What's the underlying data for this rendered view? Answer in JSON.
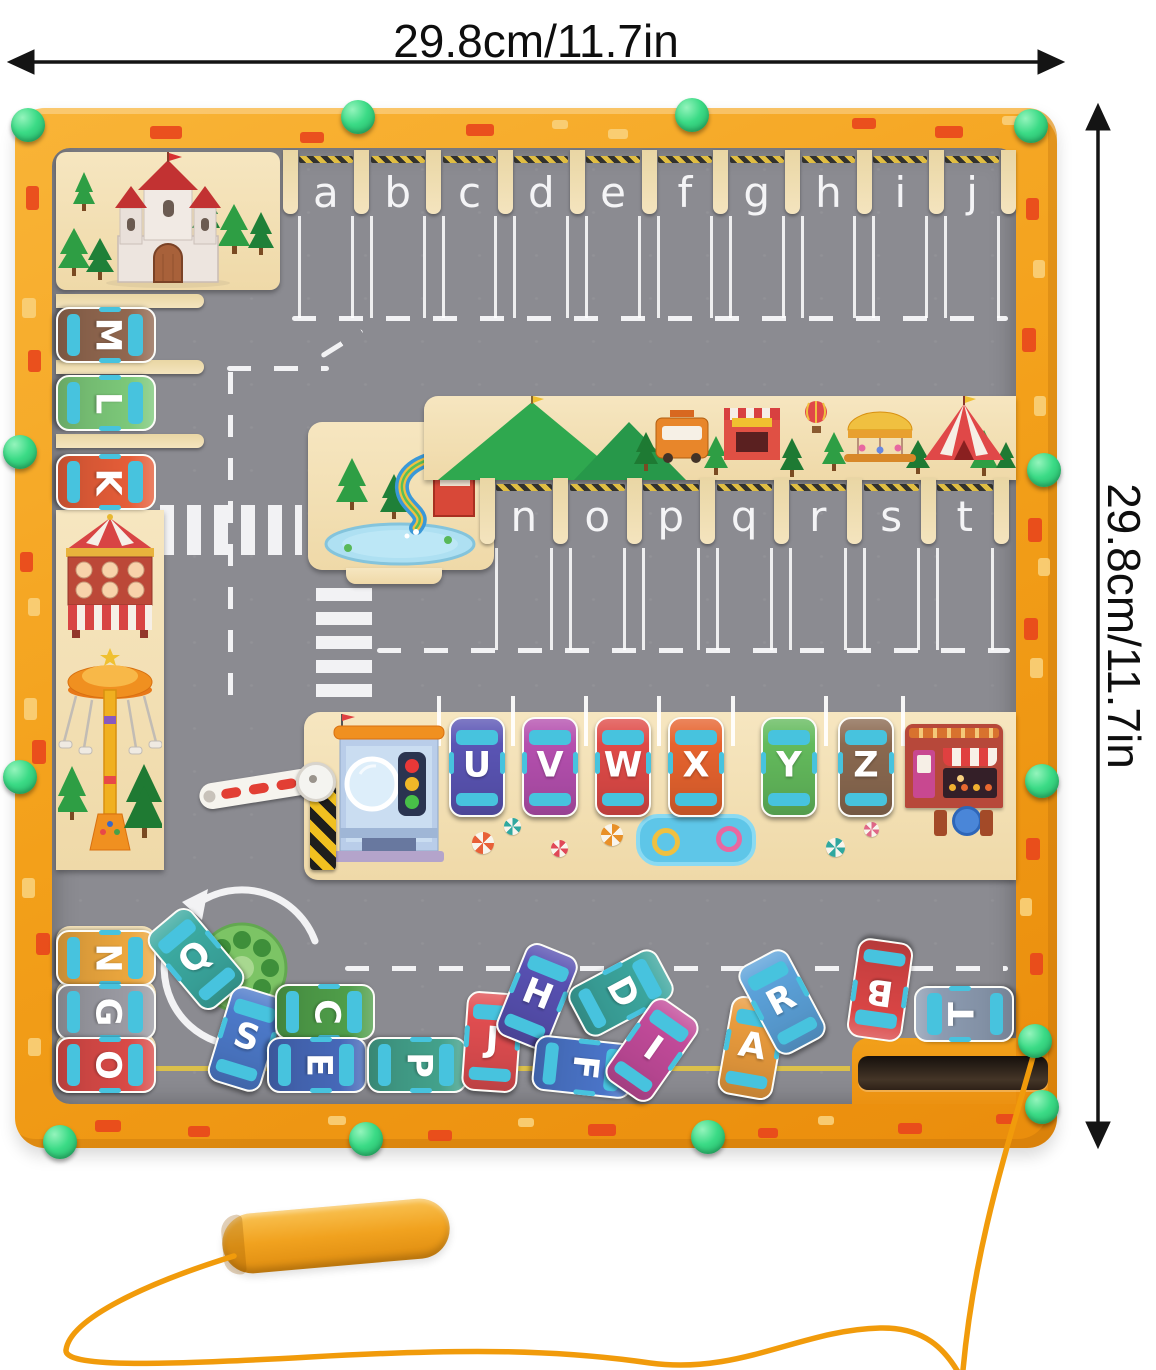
{
  "dimensions": {
    "top_label": "29.8cm/11.7in",
    "right_label": "29.8cm/11.7in"
  },
  "palette": {
    "frame": "#F3A01A",
    "road": "#8B8B91",
    "wood": "#F2DFB6",
    "knob": "#3BDB86",
    "marking": "#F2F2F4",
    "string": "#F19B0B",
    "hazard_yellow": "#E8C23C",
    "brick_red": "#E8481C"
  },
  "board": {
    "top_slot_letters": [
      "a",
      "b",
      "c",
      "d",
      "e",
      "f",
      "g",
      "h",
      "i",
      "j"
    ],
    "mid_slot_letters": [
      "n",
      "o",
      "p",
      "q",
      "r",
      "s",
      "t"
    ],
    "left_parked_cars": [
      {
        "letter": "M",
        "color": "#91674F"
      },
      {
        "letter": "L",
        "color": "#7CC879"
      },
      {
        "letter": "K",
        "color": "#E55D38"
      }
    ],
    "station_parked_cars": [
      {
        "letter": "U",
        "color": "#5A54B4"
      },
      {
        "letter": "V",
        "color": "#B44FAE"
      },
      {
        "letter": "W",
        "color": "#DF4A47"
      },
      {
        "letter": "X",
        "color": "#E6632E"
      },
      {
        "letter": "Y",
        "color": "#63BA5C"
      },
      {
        "letter": "Z",
        "color": "#8A6950"
      }
    ],
    "scattered_cars": [
      {
        "letter": "N",
        "color": "#ECA73E",
        "cx": 104,
        "cy": 956,
        "rot": 90
      },
      {
        "letter": "G",
        "color": "#9B9BA3",
        "cx": 104,
        "cy": 1010,
        "rot": 90
      },
      {
        "letter": "O",
        "color": "#D94A47",
        "cx": 104,
        "cy": 1063,
        "rot": 90
      },
      {
        "letter": "Q",
        "color": "#3BA9A0",
        "cx": 194,
        "cy": 957,
        "rot": -40
      },
      {
        "letter": "S",
        "color": "#4C79C9",
        "cx": 244,
        "cy": 1037,
        "rot": 17
      },
      {
        "letter": "C",
        "color": "#4F9E49",
        "cx": 323,
        "cy": 1010,
        "rot": 90
      },
      {
        "letter": "E",
        "color": "#4668B8",
        "cx": 315,
        "cy": 1063,
        "rot": 90
      },
      {
        "letter": "P",
        "color": "#43A18B",
        "cx": 415,
        "cy": 1063,
        "rot": 90
      },
      {
        "letter": "J",
        "color": "#E04D50",
        "cx": 490,
        "cy": 1040,
        "rot": 4
      },
      {
        "letter": "H",
        "color": "#5750B1",
        "cx": 535,
        "cy": 994,
        "rot": 22
      },
      {
        "letter": "D",
        "color": "#3BA59D",
        "cx": 619,
        "cy": 991,
        "rot": 62
      },
      {
        "letter": "F",
        "color": "#4A74C8",
        "cx": 581,
        "cy": 1065,
        "rot": 96
      },
      {
        "letter": "I",
        "color": "#C14A99",
        "cx": 650,
        "cy": 1048,
        "rot": 35
      },
      {
        "letter": "A",
        "color": "#E99B3D",
        "cx": 750,
        "cy": 1046,
        "rot": 10
      },
      {
        "letter": "R",
        "color": "#5BA1D9",
        "cx": 780,
        "cy": 1000,
        "rot": -28
      },
      {
        "letter": "B",
        "color": "#D94545",
        "cx": 878,
        "cy": 988,
        "rot": 188
      },
      {
        "letter": "T",
        "color": "#8C9BB1",
        "cx": 962,
        "cy": 1012,
        "rot": -90
      }
    ],
    "knobs": [
      [
        28,
        125
      ],
      [
        358,
        117
      ],
      [
        692,
        115
      ],
      [
        1031,
        126
      ],
      [
        20,
        452
      ],
      [
        20,
        777
      ],
      [
        1044,
        470
      ],
      [
        1042,
        781
      ],
      [
        1035,
        1041
      ],
      [
        1042,
        1107
      ],
      [
        60,
        1142
      ],
      [
        366,
        1139
      ],
      [
        708,
        1137
      ]
    ],
    "bricks": [
      [
        150,
        126,
        32,
        13,
        0
      ],
      [
        300,
        132,
        24,
        11,
        0
      ],
      [
        466,
        124,
        28,
        12,
        0
      ],
      [
        552,
        120,
        16,
        9,
        1
      ],
      [
        608,
        129,
        20,
        10,
        1
      ],
      [
        852,
        118,
        24,
        11,
        0
      ],
      [
        935,
        126,
        28,
        12,
        0
      ],
      [
        1002,
        116,
        18,
        9,
        1
      ],
      [
        26,
        186,
        13,
        24,
        0
      ],
      [
        22,
        298,
        14,
        20,
        1
      ],
      [
        28,
        350,
        13,
        22,
        0
      ],
      [
        20,
        552,
        13,
        20,
        0
      ],
      [
        28,
        598,
        12,
        18,
        1
      ],
      [
        24,
        698,
        13,
        22,
        1
      ],
      [
        32,
        740,
        14,
        24,
        0
      ],
      [
        22,
        878,
        13,
        20,
        1
      ],
      [
        36,
        933,
        14,
        22,
        0
      ],
      [
        28,
        1038,
        13,
        18,
        1
      ],
      [
        1026,
        198,
        13,
        22,
        0
      ],
      [
        1033,
        260,
        12,
        18,
        1
      ],
      [
        1022,
        328,
        14,
        24,
        0
      ],
      [
        1034,
        396,
        12,
        20,
        1
      ],
      [
        1028,
        518,
        14,
        24,
        0
      ],
      [
        1038,
        558,
        12,
        18,
        1
      ],
      [
        1024,
        618,
        14,
        22,
        0
      ],
      [
        1030,
        658,
        13,
        20,
        1
      ],
      [
        1026,
        838,
        14,
        22,
        0
      ],
      [
        1020,
        898,
        12,
        18,
        1
      ],
      [
        1030,
        953,
        13,
        22,
        0
      ],
      [
        95,
        1120,
        26,
        12,
        0
      ],
      [
        188,
        1126,
        22,
        11,
        0
      ],
      [
        328,
        1116,
        18,
        9,
        1
      ],
      [
        428,
        1130,
        24,
        11,
        0
      ],
      [
        518,
        1118,
        16,
        9,
        1
      ],
      [
        588,
        1124,
        28,
        12,
        0
      ],
      [
        758,
        1128,
        20,
        10,
        0
      ],
      [
        818,
        1116,
        16,
        9,
        1
      ],
      [
        898,
        1123,
        24,
        11,
        0
      ],
      [
        996,
        1114,
        20,
        10,
        0
      ]
    ]
  },
  "decorations": {
    "castle": "castle-illustration",
    "carnival_booth": "carnival-booth-illustration",
    "swing_ride": "swing-ride-illustration",
    "water_slide": "water-slide-illustration",
    "fairground": "fairground-scenery-illustration",
    "toll_station": "toll-station-illustration",
    "barrier": "barrier-arm",
    "cafe": "cafe-shop-illustration",
    "roundabout": "roundabout-illustration",
    "magnet_pen": "magnetic-pen"
  }
}
